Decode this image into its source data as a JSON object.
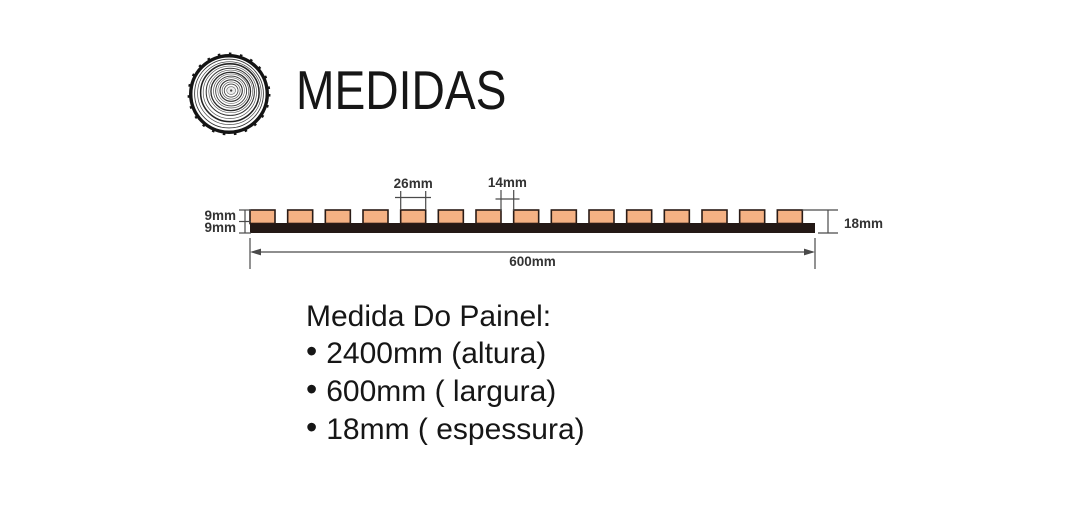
{
  "page": {
    "background": "#ffffff",
    "text_color": "#161616"
  },
  "header": {
    "title": "MEDIDAS",
    "icon": "wood-log-cross-section-icon"
  },
  "diagram": {
    "kind": "slatted-panel-cross-section",
    "slat_count": 15,
    "labels": {
      "slat_width": "26mm",
      "gap_width": "14mm",
      "slat_thickness": "9mm",
      "base_thickness": "9mm",
      "panel_width": "600mm",
      "total_thickness": "18mm"
    },
    "colors": {
      "slat_fill": "#f4b184",
      "slat_stroke": "#2a1b16",
      "base_fill": "#231815",
      "dim_line": "#4a4a4a",
      "dim_text": "#333333"
    }
  },
  "specs": {
    "heading": "Medida Do Painel:",
    "bullet": "•",
    "items": [
      {
        "text": "2400mm (altura)"
      },
      {
        "text": "600mm ( largura)"
      },
      {
        "text": "18mm ( espessura)"
      }
    ]
  }
}
